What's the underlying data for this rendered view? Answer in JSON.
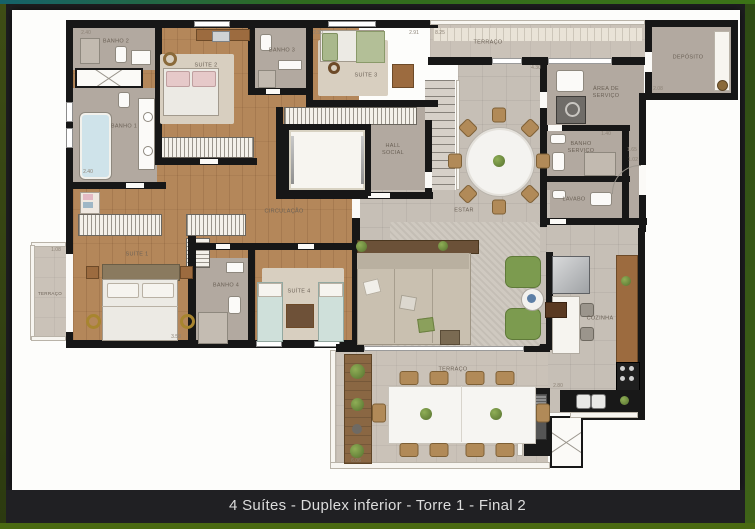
{
  "caption": "4 Suítes - Duplex inferior - Torre 1 - Final 2",
  "rooms": {
    "banho2": "BANHO 2",
    "suite2": "SUÍTE 2",
    "banho3": "BANHO 3",
    "suite3": "SUÍTE 3",
    "terraco_superior": "TERRAÇO",
    "deposito": "DEPÓSITO",
    "area_servico": "ÁREA DE SERVIÇO",
    "banho_servico": "BANHO SERVIÇO",
    "lavabo": "LAVABO",
    "hall_social": "HALL SOCIAL",
    "estar": "ESTAR",
    "circulacao": "CIRCULAÇÃO",
    "banho1": "BANHO 1",
    "suite1": "SUÍTE 1",
    "terraco_esquerdo": "TERRAÇO",
    "banho4": "BANHO 4",
    "suite4": "SUÍTE 4",
    "cozinha": "COZINHA",
    "terraco_inferior": "TERRAÇO"
  },
  "dimensions": {
    "d1": "2.40",
    "d2": "2.30",
    "d3": "2.91",
    "d4": "8.25",
    "d5": "4.30",
    "d6": "2.08",
    "d7": "1.40",
    "d8": "1.65",
    "d9": "1.02",
    "d10": "2.40",
    "d11": "1.08",
    "d12": "3.58",
    "d13": "2.80",
    "d14": "6.06"
  },
  "colors": {
    "wall": "#171717",
    "wood_floor": "#b4875a",
    "tile_floor": "#c6bfb6",
    "accent_green": "#7c9b4f",
    "frame_green": "#4a6a12",
    "caption_bg": "#202023",
    "caption_text": "#dcdcdc"
  }
}
